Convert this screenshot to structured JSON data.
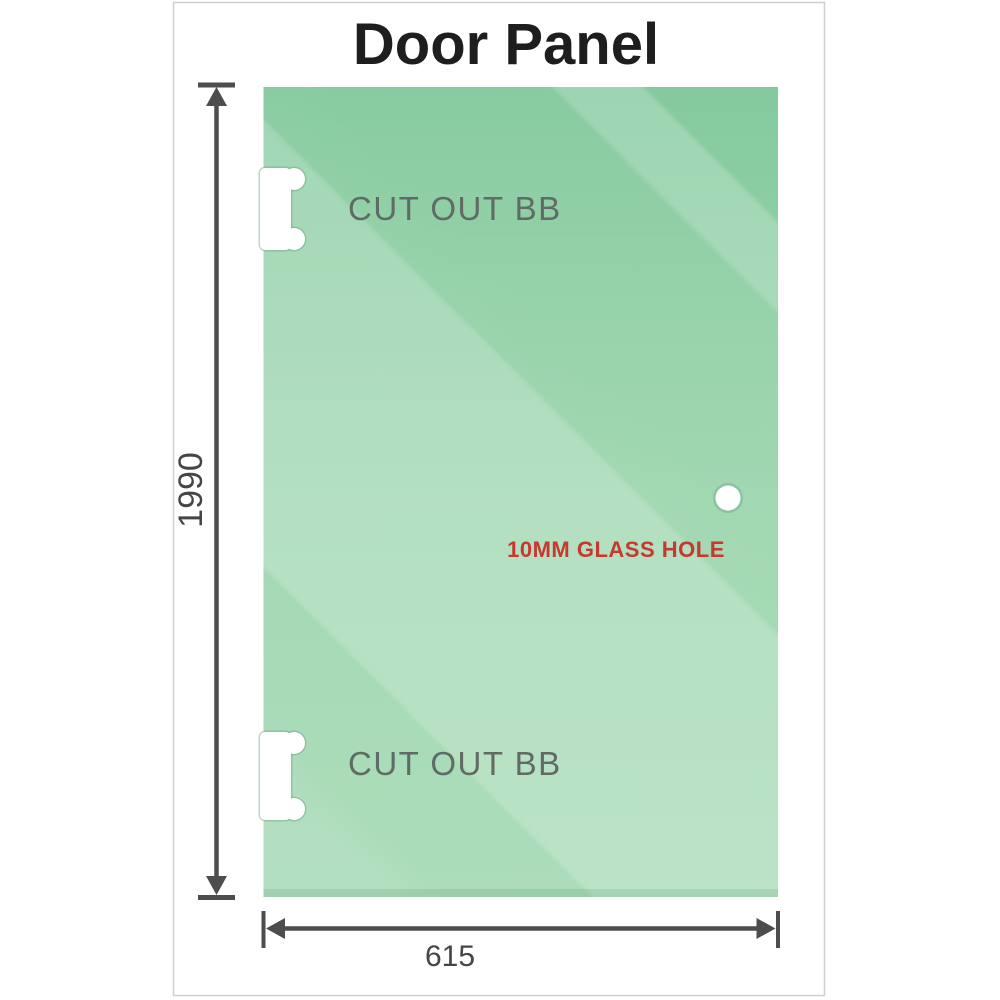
{
  "title": "Door Panel",
  "title_color": "#1e1e1e",
  "frame": {
    "border_color": "#cfcfcf",
    "background": "#ffffff"
  },
  "panel": {
    "color_top": "#7ec799",
    "color_mid": "#99d4ab",
    "color_bottom": "#a3d9b3",
    "cutout_top_label": "CUT OUT BB",
    "cutout_bottom_label": "CUT OUT BB",
    "hole_label": "10MM GLASS HOLE",
    "hole_label_color": "#c5392f"
  },
  "dimensions": {
    "height": "1990",
    "width": "615",
    "line_color": "#4d4d4d",
    "text_color": "#454545"
  }
}
